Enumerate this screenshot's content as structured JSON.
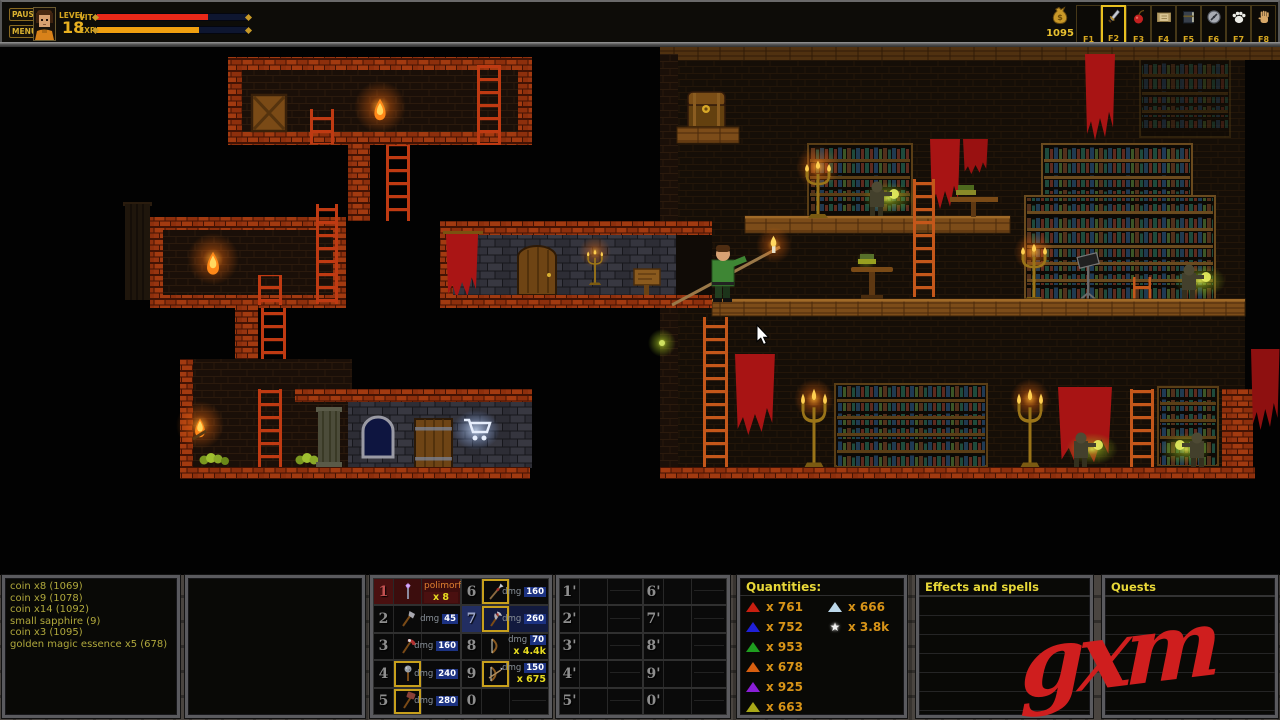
{
  "topbar": {
    "pause": "PAUSE",
    "menu": "MENU",
    "level_label": "LEVEL",
    "level_value": "18",
    "vit_label": "VIT",
    "exp_label": "EXP",
    "vit_fill": "74%",
    "exp_fill": "68%",
    "vit_color": "#e82818",
    "exp_color": "#f0a010",
    "coins": "1095",
    "fslots": [
      {
        "key": "F1",
        "icon": "empty"
      },
      {
        "key": "F2",
        "icon": "sword-icon",
        "selected": true
      },
      {
        "key": "F3",
        "icon": "fruit-icon"
      },
      {
        "key": "F4",
        "icon": "scroll-icon"
      },
      {
        "key": "F5",
        "icon": "book-icon"
      },
      {
        "key": "F6",
        "icon": "compass-icon"
      },
      {
        "key": "F7",
        "icon": "paw-icon"
      },
      {
        "key": "F8",
        "icon": "hand-icon"
      }
    ]
  },
  "log": {
    "lines": [
      "coin x8 (1069)",
      "coin x9 (1078)",
      "coin x14 (1092)",
      "small sapphire (9)",
      "coin x3 (1095)",
      "golden magic essence x5 (678)"
    ]
  },
  "hotbar": {
    "slots": [
      {
        "num": "1",
        "name": "polimorf",
        "count": "x 8",
        "icon": "wand-icon",
        "state": "selected-red"
      },
      {
        "num": "2",
        "dmg_label": "dmg",
        "dmg": "45",
        "icon": "axe-icon"
      },
      {
        "num": "3",
        "dmg_label": "dmg",
        "dmg": "160",
        "icon": "warpick-icon"
      },
      {
        "num": "4",
        "dmg_label": "dmg",
        "dmg": "240",
        "icon": "mace-icon",
        "equipped": true
      },
      {
        "num": "5",
        "dmg_label": "dmg",
        "dmg": "280",
        "icon": "hammer-icon",
        "equipped": true
      },
      {
        "num": "6",
        "dmg_label": "dmg",
        "dmg": "160",
        "icon": "spear-icon",
        "equipped": true
      },
      {
        "num": "7",
        "dmg_label": "dmg",
        "dmg": "260",
        "icon": "battleaxe-icon",
        "equipped": true,
        "state": "selected-blue"
      },
      {
        "num": "8",
        "dmg_label": "dmg",
        "dmg": "70",
        "count": "x 4.4k",
        "icon": "bow-icon"
      },
      {
        "num": "9",
        "dmg_label": "dmg",
        "dmg": "150",
        "count": "x 675",
        "icon": "bow-arrow-icon",
        "equipped": true
      },
      {
        "num": "0",
        "icon": "empty"
      }
    ]
  },
  "hotbar2": {
    "nums": [
      "1'",
      "2'",
      "3'",
      "4'",
      "5'",
      "6'",
      "7'",
      "8'",
      "9'",
      "0'"
    ]
  },
  "quantities": {
    "header": "Quantities:",
    "left": [
      {
        "icon": "triangle",
        "color": "#c81f10",
        "value": "x  761"
      },
      {
        "icon": "triangle",
        "color": "#2020d8",
        "value": "x  752"
      },
      {
        "icon": "triangle",
        "color": "#1f9e1f",
        "value": "x  953"
      },
      {
        "icon": "triangle",
        "color": "#d85f10",
        "value": "x  678"
      },
      {
        "icon": "triangle",
        "color": "#8a1fd8",
        "value": "x  925"
      },
      {
        "icon": "triangle",
        "color": "#a8a818",
        "value": "x  663"
      }
    ],
    "right": [
      {
        "icon": "triangle",
        "color": "#bcd8ea",
        "value": "x  666"
      },
      {
        "icon": "star",
        "color": "#ffffff",
        "value": "x  3.8k"
      }
    ]
  },
  "effects_panel": {
    "header": "Effects and spells"
  },
  "quests_panel": {
    "header": "Quests"
  },
  "watermark": {
    "text": "gxm"
  }
}
